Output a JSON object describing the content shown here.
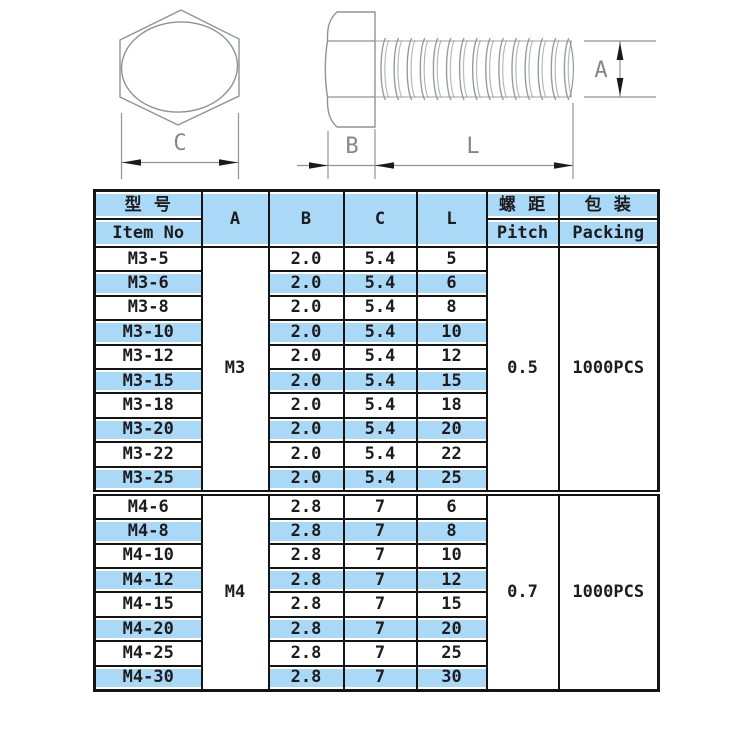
{
  "drawing": {
    "front_view": {
      "dim_label": "C"
    },
    "side_view": {
      "dim_a": "A",
      "dim_b": "B",
      "dim_l": "L"
    },
    "colors": {
      "line": "#8e939a",
      "arrow": "#1a1a1a",
      "label": "#82868d"
    }
  },
  "table": {
    "header": {
      "item_no_cn": "型 号",
      "item_no_en": "Item No",
      "col_a": "A",
      "col_b": "B",
      "col_c": "C",
      "col_l": "L",
      "pitch_cn": "螺 距",
      "pitch_en": "Pitch",
      "packing_cn": "包 装",
      "packing_en": "Packing"
    },
    "colors": {
      "header_fill": "#a9d9f7",
      "row_highlight": "#a9d9f7",
      "border": "#141414"
    },
    "sections": [
      {
        "a": "M3",
        "pitch": "0.5",
        "packing": "1000PCS",
        "rows": [
          {
            "item": "M3-5",
            "b": "2.0",
            "c": "5.4",
            "l": "5"
          },
          {
            "item": "M3-6",
            "b": "2.0",
            "c": "5.4",
            "l": "6"
          },
          {
            "item": "M3-8",
            "b": "2.0",
            "c": "5.4",
            "l": "8"
          },
          {
            "item": "M3-10",
            "b": "2.0",
            "c": "5.4",
            "l": "10"
          },
          {
            "item": "M3-12",
            "b": "2.0",
            "c": "5.4",
            "l": "12"
          },
          {
            "item": "M3-15",
            "b": "2.0",
            "c": "5.4",
            "l": "15"
          },
          {
            "item": "M3-18",
            "b": "2.0",
            "c": "5.4",
            "l": "18"
          },
          {
            "item": "M3-20",
            "b": "2.0",
            "c": "5.4",
            "l": "20"
          },
          {
            "item": "M3-22",
            "b": "2.0",
            "c": "5.4",
            "l": "22"
          },
          {
            "item": "M3-25",
            "b": "2.0",
            "c": "5.4",
            "l": "25"
          }
        ]
      },
      {
        "a": "M4",
        "pitch": "0.7",
        "packing": "1000PCS",
        "rows": [
          {
            "item": "M4-6",
            "b": "2.8",
            "c": "7",
            "l": "6"
          },
          {
            "item": "M4-8",
            "b": "2.8",
            "c": "7",
            "l": "8"
          },
          {
            "item": "M4-10",
            "b": "2.8",
            "c": "7",
            "l": "10"
          },
          {
            "item": "M4-12",
            "b": "2.8",
            "c": "7",
            "l": "12"
          },
          {
            "item": "M4-15",
            "b": "2.8",
            "c": "7",
            "l": "15"
          },
          {
            "item": "M4-20",
            "b": "2.8",
            "c": "7",
            "l": "20"
          },
          {
            "item": "M4-25",
            "b": "2.8",
            "c": "7",
            "l": "25"
          },
          {
            "item": "M4-30",
            "b": "2.8",
            "c": "7",
            "l": "30"
          }
        ]
      }
    ]
  }
}
